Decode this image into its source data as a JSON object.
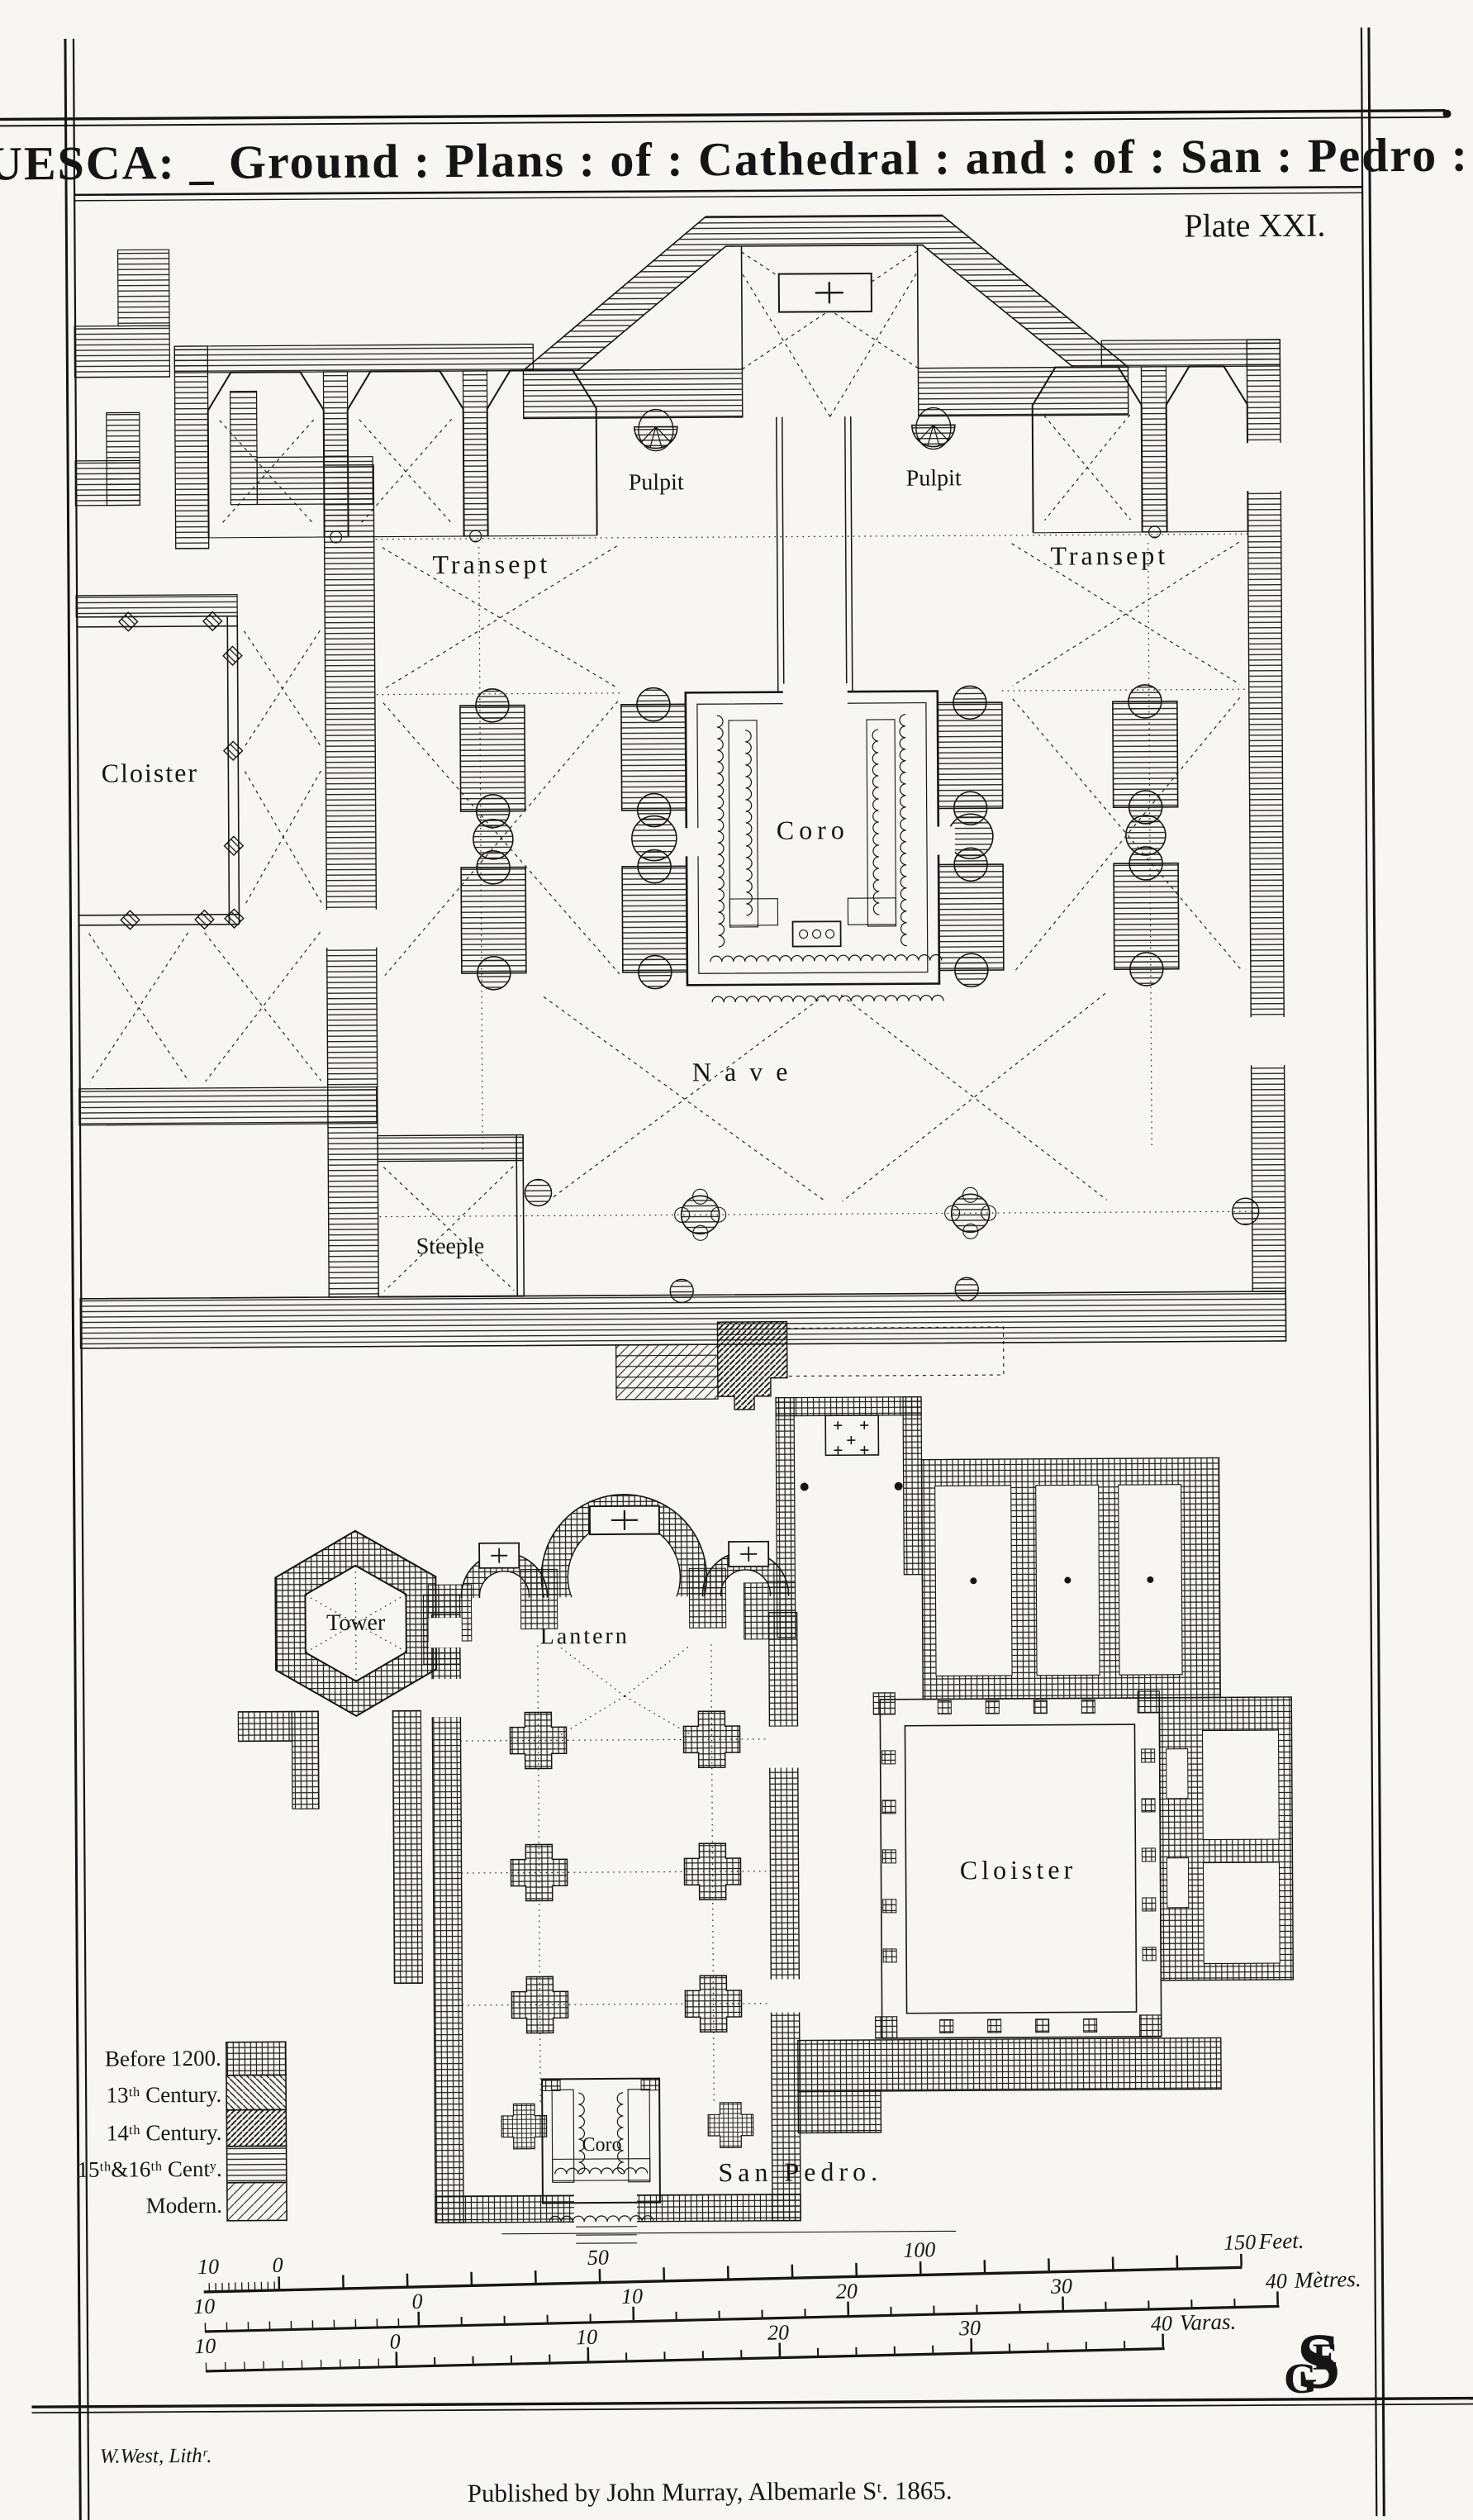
{
  "plate": {
    "title": "HUESCA: _ Ground : Plans : of : Cathedral : and : of : San : Pedro :",
    "number": "Plate XXI."
  },
  "cathedral": {
    "pulpit_left": "Pulpit",
    "pulpit_right": "Pulpit",
    "transept_left": "Transept",
    "transept_right": "Transept",
    "cloister": "Cloister",
    "coro": "Coro",
    "nave": "Nave",
    "steeple": "Steeple"
  },
  "san_pedro": {
    "tower": "Tower",
    "lantern": "Lantern",
    "cloister": "Cloister",
    "coro": "Coro",
    "caption": "San Pedro."
  },
  "legend": {
    "items": [
      {
        "label": "Before 1200.",
        "period": "before-1200",
        "pattern": "crosshatch"
      },
      {
        "label": "13ᵗʰ Century.",
        "period": "13th-century",
        "pattern": "diagonal-backslash"
      },
      {
        "label": "14ᵗʰ Century.",
        "period": "14th-century",
        "pattern": "diagonal-forward-dense"
      },
      {
        "label": "15ᵗʰ&16ᵗʰ Centʸ.",
        "period": "15th-16th-century",
        "pattern": "horizontal-lines"
      },
      {
        "label": "Modern.",
        "period": "modern",
        "pattern": "diagonal-sparse"
      }
    ]
  },
  "scales": {
    "feet": {
      "labels": [
        "10",
        "0",
        "50",
        "100",
        "150"
      ],
      "unit": "Feet."
    },
    "metres": {
      "labels": [
        "10",
        "0",
        "10",
        "20",
        "30",
        "40"
      ],
      "unit": "Mètres."
    },
    "varas": {
      "labels": [
        "10",
        "0",
        "10",
        "20",
        "30",
        "40"
      ],
      "unit": "Varas."
    }
  },
  "credits": {
    "lithographer": "W.West, Lithʳ.",
    "publisher": "Published by John Murray, Albemarle Sᵗ. 1865."
  },
  "monogram": {
    "letters": [
      "G",
      "E",
      "S"
    ]
  },
  "colors": {
    "ink": "#151515",
    "paper": "#f7f6f2"
  }
}
